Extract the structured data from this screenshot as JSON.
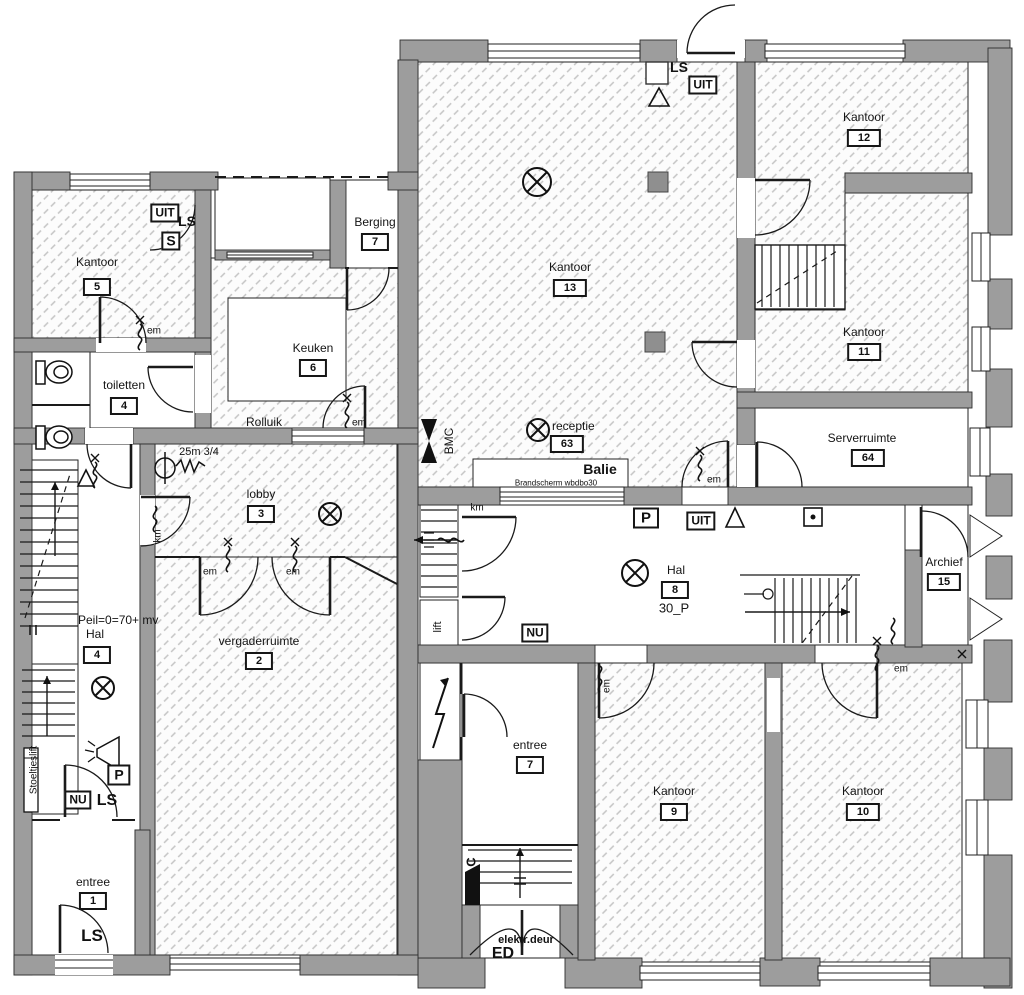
{
  "plan": {
    "rooms": [
      {
        "name": "Kantoor",
        "number": "5"
      },
      {
        "name": "toiletten",
        "number": "4"
      },
      {
        "name": "Keuken",
        "number": "6"
      },
      {
        "name": "Berging",
        "number": "7"
      },
      {
        "name": "Kantoor",
        "number": "13"
      },
      {
        "name": "Kantoor",
        "number": "12"
      },
      {
        "name": "Kantoor",
        "number": "11"
      },
      {
        "name": "Serverruimte",
        "number": "64"
      },
      {
        "name": "receptie",
        "number": "63"
      },
      {
        "name": "Hal",
        "number": "8"
      },
      {
        "name": "Archief",
        "number": "15"
      },
      {
        "name": "lobby",
        "number": "3"
      },
      {
        "name": "vergaderruimte",
        "number": "2"
      },
      {
        "name": "Hal",
        "number": "4"
      },
      {
        "name": "entree",
        "number": "1"
      },
      {
        "name": "entree",
        "number": "7"
      },
      {
        "name": "Kantoor",
        "number": "9"
      },
      {
        "name": "Kantoor",
        "number": "10"
      }
    ],
    "annotations": {
      "balie": "Balie",
      "brandscherm": "Brandscherm wbdbo30",
      "rolluik": "Rolluik",
      "hose": "25m 3/4",
      "peil": "Peil=0=70+ mv",
      "hal8_sub": "30_P",
      "stoeltjeslift": "Stoeltjeslift",
      "elektr_deur": "elektr.deur",
      "ed": "ED",
      "bmc": "BMC",
      "lift": "lift",
      "km": "km",
      "em": "em",
      "ls": "LS",
      "uit": "UIT",
      "nu": "NU",
      "p": "P",
      "s": "S",
      "c": "C"
    },
    "colors": {
      "wall": "#9d9d9d",
      "hatch": "#c4c4c4",
      "line": "#1a1a1a"
    }
  }
}
